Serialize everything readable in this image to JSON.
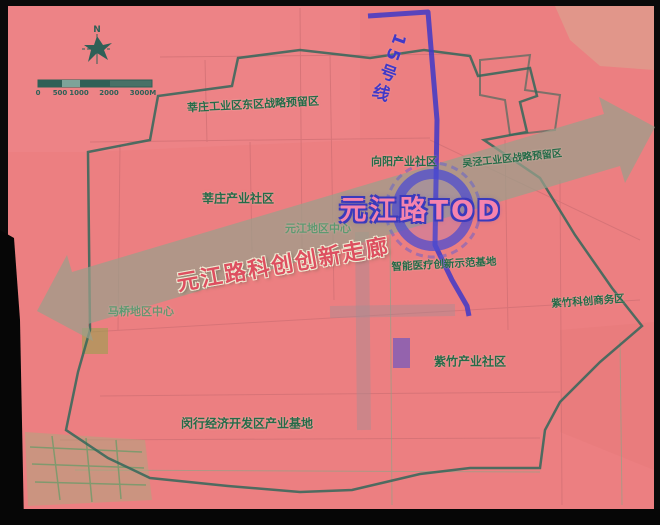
{
  "map": {
    "tod_title": "元江路TOD",
    "corridor_title": "元江路科创创新走廊",
    "metro_line_label": "15号线",
    "compass_label": "N",
    "scale": {
      "labels": [
        "0",
        "500",
        "1000",
        "2000",
        "3000M"
      ]
    },
    "labels": {
      "top_reserve": "莘庄工业区东区战略预留区",
      "xinzhuang_community": "莘庄产业社区",
      "xiangyang_community": "向阳产业社区",
      "wujing_reserve": "吴泾工业区战略预留区",
      "yuanjiang_center": "元江地区中心",
      "smart_medical": "智能医疗创新示范基地",
      "zizhu_business": "紫竹科创商务区",
      "maqiao_center": "马桥地区中心",
      "zizhu_community": "紫竹产业社区",
      "minhang_base": "闵行经济开发区产业基地"
    },
    "colors": {
      "map_pink": "#ec7f81",
      "boundary_green": "#33675a",
      "corridor_band_gray": "#9aa08b",
      "metro_blue": "#4038c8",
      "tod_text_pink": "#f583ad",
      "area_label_green": "#256b48",
      "corridor_text_red": "#dd4f60"
    }
  }
}
